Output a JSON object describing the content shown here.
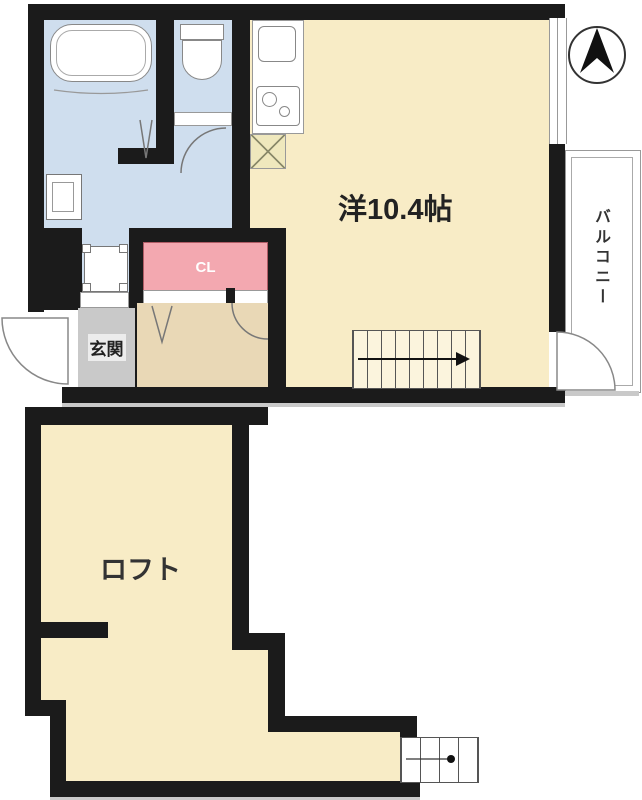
{
  "title": "floor-plan",
  "labels": {
    "main_room": "洋10.4帖",
    "balcony": "バルコニー",
    "entrance": "玄関",
    "closet": "CL",
    "loft": "ロフト"
  },
  "icons": {
    "compass": "north-arrow-compass",
    "stairs_arrow": "stairs-direction-arrow",
    "ladder_dot": "ladder-direction-dot"
  },
  "palette": {
    "wall": "#1b1b1b",
    "room_cream": "#f8ecc6",
    "corridor_tan": "#e9d8b6",
    "wet_blue": "#cfdeee",
    "closet_pink": "#f3a8b0",
    "genkan_gray": "#c9c9c9",
    "pan_yellow": "#efe8bd",
    "outline_gray": "#888888"
  }
}
